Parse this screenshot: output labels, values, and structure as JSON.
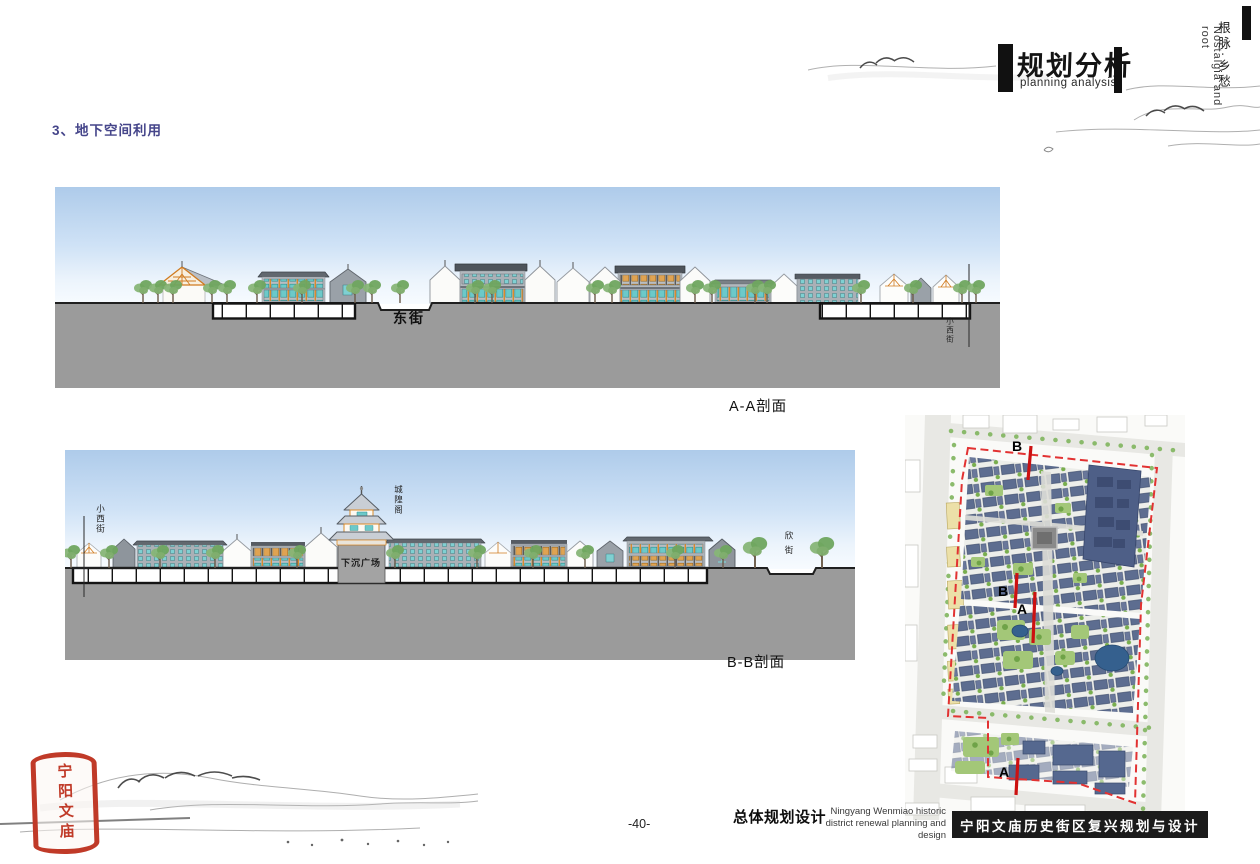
{
  "page": {
    "heading": "3、地下空间利用",
    "page_number": "-40-"
  },
  "header": {
    "title_cn": "规划分析",
    "title_en": "planning analysis",
    "side_chinese": "根脉·乡愁",
    "side_english": "Nostalgia and root"
  },
  "section_aa": {
    "caption": "A-A剖面",
    "street_label": "东街",
    "right_street_label": "小西街"
  },
  "section_bb": {
    "caption": "B-B剖面",
    "left_street_label": "小西街",
    "tower_label": "城隍阁",
    "plaza_label": "下沉广场",
    "right_street_label": "欣街"
  },
  "map": {
    "marker_b_top": "B",
    "marker_b_mid": "B",
    "marker_a_mid": "A",
    "marker_a_bottom": "A",
    "boundary_color": "#e23232",
    "section_line_color": "#cc1111"
  },
  "footer": {
    "title_cn": "总体规划设计",
    "subtitle_en_line1": "Ningyang Wenmiao historic",
    "subtitle_en_line2": "district renewal planning and design",
    "banner_text": "宁阳文庙历史街区复兴规划与设计",
    "banner_bg": "#1b1b1b"
  },
  "seal": {
    "text": "宁阳文庙",
    "color": "#c03a28"
  },
  "colors": {
    "heading": "#45458a",
    "ground_grey": "#9b9b9b",
    "sky_top": "#aecbea",
    "teal_window": "#6cc9c9",
    "timber_orange": "#d98b2b"
  }
}
